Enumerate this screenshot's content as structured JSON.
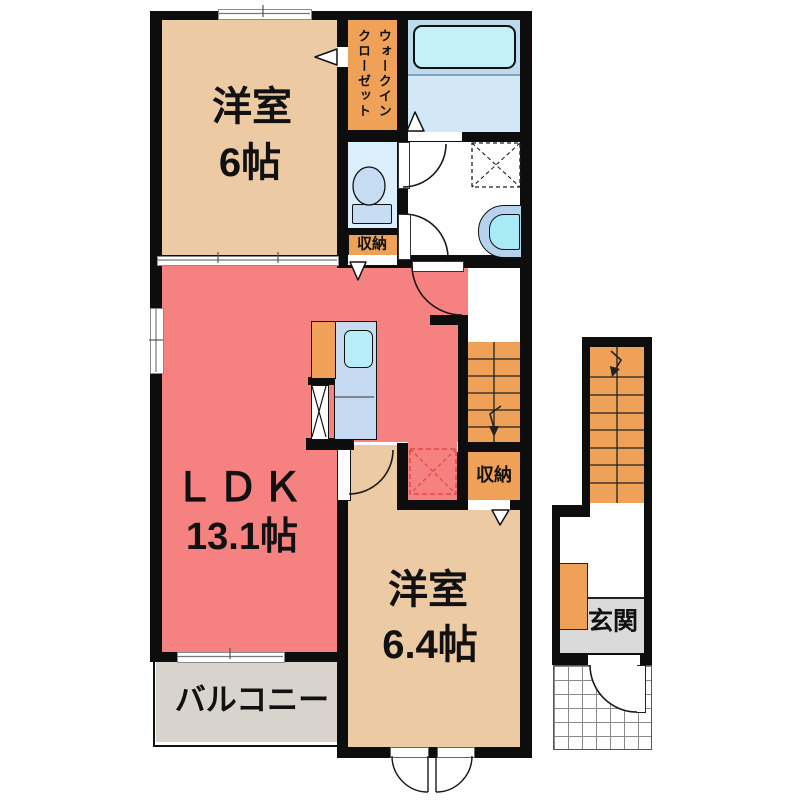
{
  "plan_title": "2F floor plan",
  "rooms": {
    "bedroom1": {
      "label": "洋室",
      "size": "6帖"
    },
    "ldk": {
      "label": "ＬＤＫ",
      "size": "13.1帖"
    },
    "bedroom2": {
      "label": "洋室",
      "size": "6.4帖"
    },
    "balcony": {
      "label": "バルコニー"
    },
    "entrance": {
      "label": "玄関"
    },
    "walk_in_closet": {
      "line1": "ウォークイン",
      "line2": "クローゼット"
    },
    "storage_top": {
      "label": "収納"
    },
    "storage_bottom": {
      "label": "収納"
    }
  },
  "colors": {
    "wall": "#0d0d0d",
    "room_beige": "#eccaa3",
    "ldk_salmon": "#f58181",
    "accent_orange": "#efa257",
    "bath_blue": "#bcd9ee",
    "bath_blue_light": "#d3e8f6",
    "tub_cyan": "#c4f1f9",
    "toilet_room_blue": "#dbeefb",
    "fixture_blue": "#c6dcf3",
    "sink_cyan": "#b7eef7",
    "balcony_gray": "#d8d4cd",
    "entrance_gray": "#dadada",
    "fridge_marker_red": "#e04848"
  }
}
